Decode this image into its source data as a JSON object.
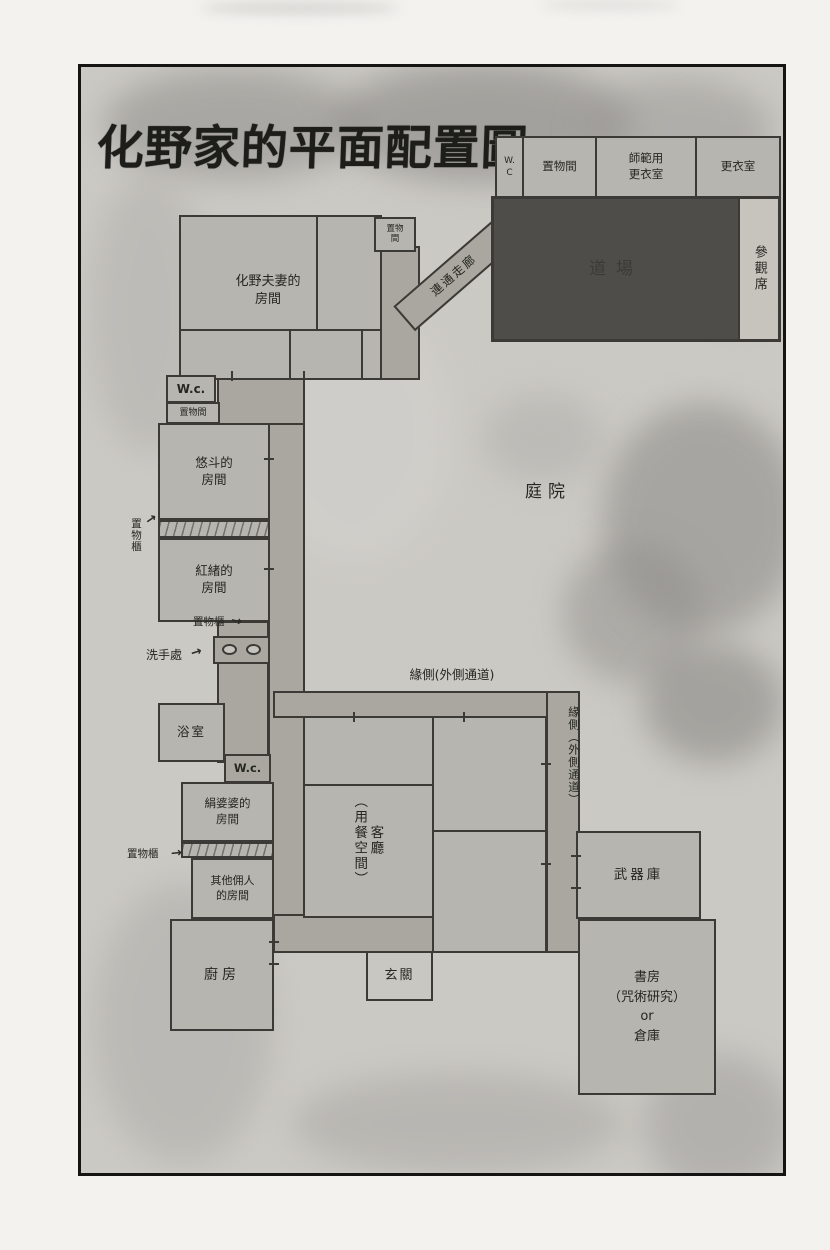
{
  "page": {
    "title": "化野家的平面配置圖"
  },
  "palette": {
    "paper": "#f3f2ef",
    "panel": "#cbc9c4",
    "room": "#b7b5af",
    "cor": "#a9a79f",
    "dojo": "#4e4d4a",
    "spect": "#c6c4bd",
    "entr": "#c9c7c1",
    "wall": "#3b3a36",
    "ink": "#262622"
  },
  "icons": {
    "arrow": "→",
    "washbasin": "oval-basin-shape"
  },
  "labels": {
    "courtyard": "庭院",
    "engawa_h": "緣側(外側通道)",
    "engawa_v": "緣側（外側通道）",
    "corridor_diag": "連通走廊"
  },
  "rooms": {
    "wc_top": "W.\nC",
    "storage_top": "置物間",
    "instructor_changing": "師範用\n更衣室",
    "changing_room": "更衣室",
    "dojo": "道場",
    "spectator_seats": "參觀席",
    "storage_small_top": "置物\n間",
    "parents_room": "化野夫妻的\n房間",
    "wc_left": "W.c.",
    "storage_left": "置物間",
    "yuto_room": "悠斗的\n房間",
    "closet1": "置物櫃",
    "benio_room": "紅緒的\n房間",
    "closet2": "置物櫃",
    "washing_area": "洗手處",
    "bath": "浴室",
    "wc_mid": "W.c.",
    "kinu_room": "絹婆婆的\n房間",
    "closet3": "置物櫃",
    "servants_room": "其他佣人\n的房間",
    "kitchen": "廚房",
    "living_room": "客廳\n（用餐空間）",
    "entrance": "玄關",
    "armory": "武器庫",
    "study": "書房\n（咒術研究）\nor\n倉庫"
  }
}
